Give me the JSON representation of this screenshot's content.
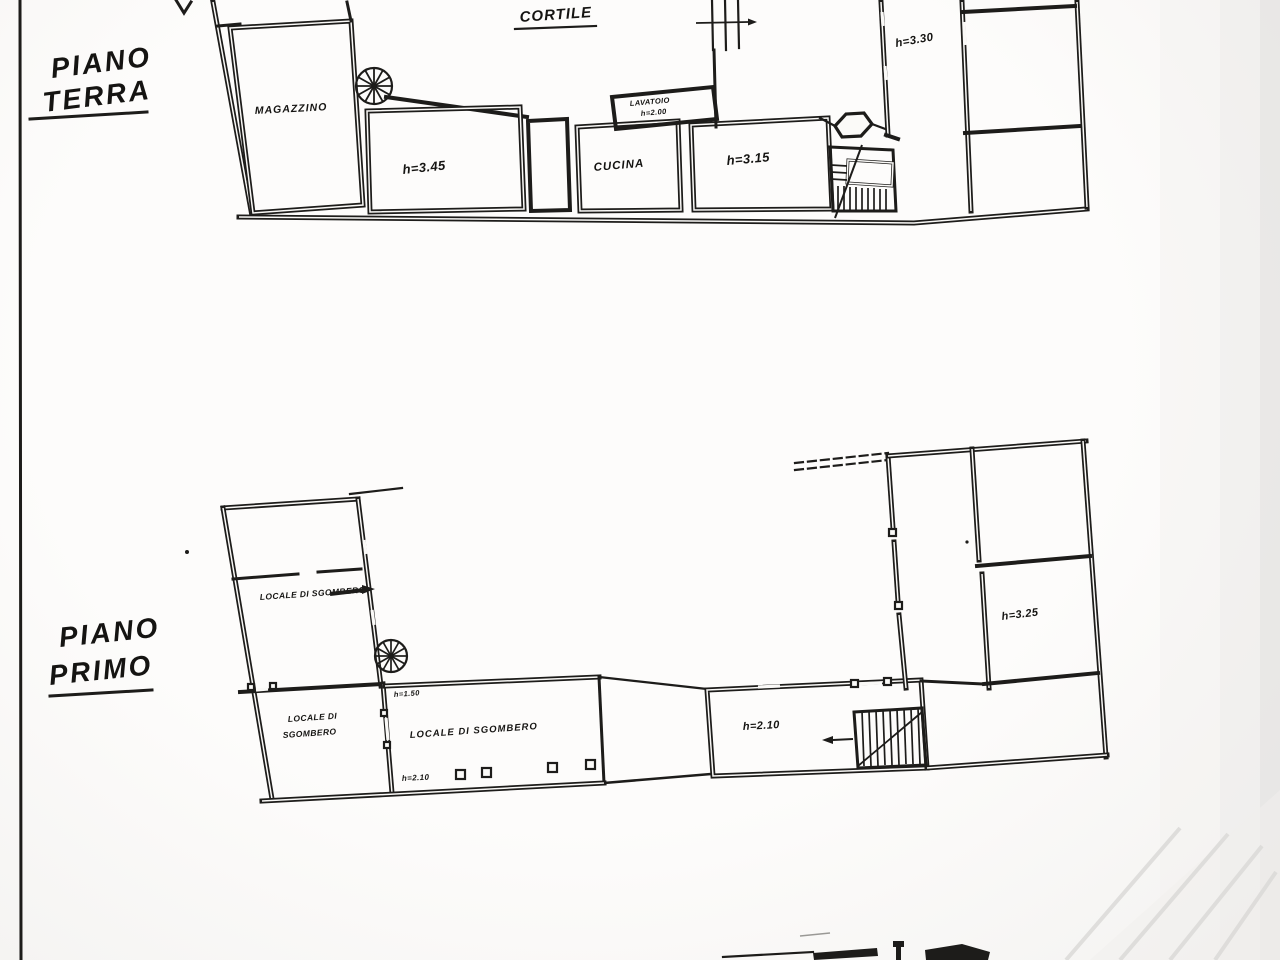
{
  "sheet": {
    "paper_color": "#fbfaf8",
    "ink_color": "#1d1c1a"
  },
  "ground_floor": {
    "title_line1": "PIANO",
    "title_line2": "TERRA",
    "labels": {
      "courtyard": "CORTILE",
      "warehouse": "MAGAZZINO",
      "room_height_345": "h=3.45",
      "kitchen": "CUCINA",
      "room_height_315": "h=3.15",
      "laundry_line1": "LAVATOIO",
      "laundry_line2": "h=2.00",
      "corridor_height_330": "h=3.30"
    }
  },
  "first_floor": {
    "title_line1": "PIANO",
    "title_line2": "PRIMO",
    "labels": {
      "storage_upper_left": "LOCALE DI SGOMBERO",
      "storage_lower_left_line1": "LOCALE DI",
      "storage_lower_left_line2": "SGOMBERO",
      "storage_main": "LOCALE DI SGOMBERO",
      "height_150": "h=1.50",
      "height_210_main": "h=2.10",
      "height_210_right": "h=2.10",
      "room_height_325": "h=3.25"
    }
  }
}
